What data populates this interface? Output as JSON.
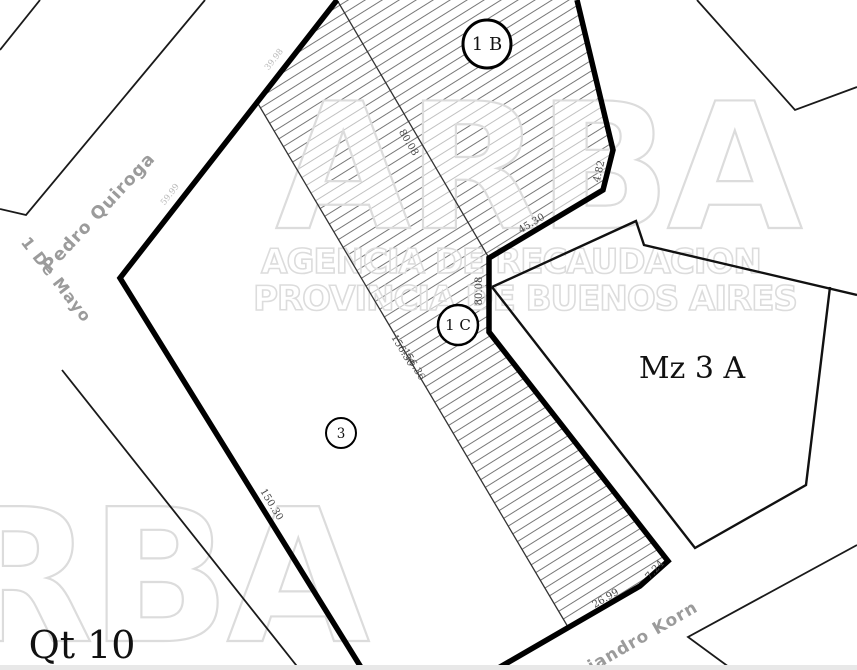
{
  "map": {
    "parcels": {
      "parcel_1b_label": "1 B",
      "parcel_1c_label": "1 C",
      "parcel_3_label": "3",
      "block_label": "Mz 3 A",
      "quarter_label": "Qt 10"
    },
    "streets": {
      "pedro_quiroga": "Pedro Quiroga",
      "de_mayo": "1 De Mayo",
      "korn": "Alejandro Korn"
    },
    "dimensions": {
      "d_80_08_a": "80.08",
      "d_80_08_b": "80.08",
      "d_45_30": "45.30",
      "d_4_82": "4.82",
      "d_156_30": "156.30",
      "d_156_36": "156.36",
      "d_150_30": "150.30",
      "d_26_99": "26.99",
      "d_7_24": "7.24",
      "d_39_98": "39.98",
      "d_59_99": "59.99"
    },
    "watermark": {
      "brand": "ARBA",
      "brand_partial": "ARBA",
      "line1": "AGENCIA DE RECAUDACION",
      "line2": "PROVINCIA DE BUENOS AIRES"
    },
    "colors": {
      "boundary": "#000000",
      "hatch_line": "#555555",
      "street_label": "#9b9b9b",
      "dimension_label": "#4a4a4a",
      "watermark": "#dcdcdc"
    }
  }
}
